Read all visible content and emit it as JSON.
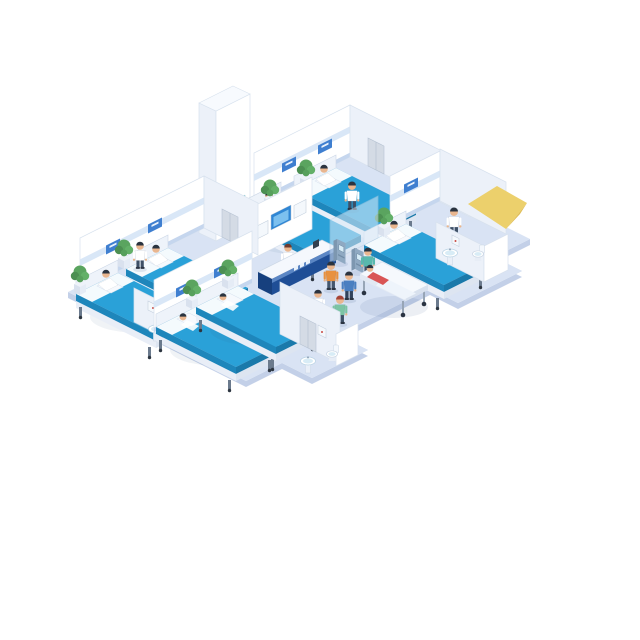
{
  "scene": {
    "name": "Isometric hospital ward illustration",
    "palette": {
      "pageBg": "#ffffff",
      "floor": "#d9e3f4",
      "floorEdge": "#c3d0e8",
      "wallWhite": "#ffffff",
      "wallShade": "#ecf1f9",
      "wallStroke": "#d8e2ee",
      "baseboard": "#c5d6ee",
      "headwallBand": "#d9e7f7",
      "signBlue": "#3f7fd0",
      "bedBlue": "#2aa1d8",
      "bedBlueDark": "#1e86bb",
      "deskNavy": "#1f4e96",
      "deskNavyDark": "#17407e",
      "deskTop": "#f5f8fd",
      "screenBlue": "#2f86d4",
      "screenGlow": "#7cc0ef",
      "kioskGray": "#8fa9c2",
      "glass": "#dcebf8",
      "plantGreen": "#5aa45f",
      "skin": "#e9b68f",
      "hairDark": "#2a333f",
      "hairRed": "#a64538",
      "scrubTeal": "#58b9ad",
      "scrubGreen": "#7cc4a4",
      "shirtOrange": "#e8913f",
      "shirtBlue": "#4a7fc1",
      "suitNavy": "#2f4a6b",
      "patientRed": "#d95555",
      "elevatorDoor": "#b5e3ea",
      "doorGray": "#d4dbe5",
      "awningYellow": "#ecd06c",
      "awningShade": "#dfbd55"
    },
    "rooms": [
      {
        "id": "ward-upper",
        "beds": 2,
        "patients": 2,
        "staff": 1,
        "plants": 2
      },
      {
        "id": "room-right",
        "beds": 1,
        "patients": 1,
        "staff": 1,
        "plants": 1,
        "bathroom": {
          "sinks": 1,
          "toilets": 1
        }
      },
      {
        "id": "ward-left",
        "beds": 2,
        "patients": 2,
        "staff": 1,
        "plants": 2,
        "bathroom": {
          "sinks": 1
        }
      },
      {
        "id": "ward-bottom",
        "beds": 2,
        "patients": 2,
        "staff": 0,
        "plants": 2,
        "bathroom": {
          "sinks": 1,
          "toilets": 1
        }
      }
    ],
    "corridor": {
      "elevators": 1,
      "nurse_station": {
        "desks": 1,
        "staff": 1,
        "wall_screens": 3
      },
      "self_service_kiosks": 2,
      "gurney": {
        "patients": 1,
        "staff": 1
      },
      "walking_figures": 4
    }
  }
}
